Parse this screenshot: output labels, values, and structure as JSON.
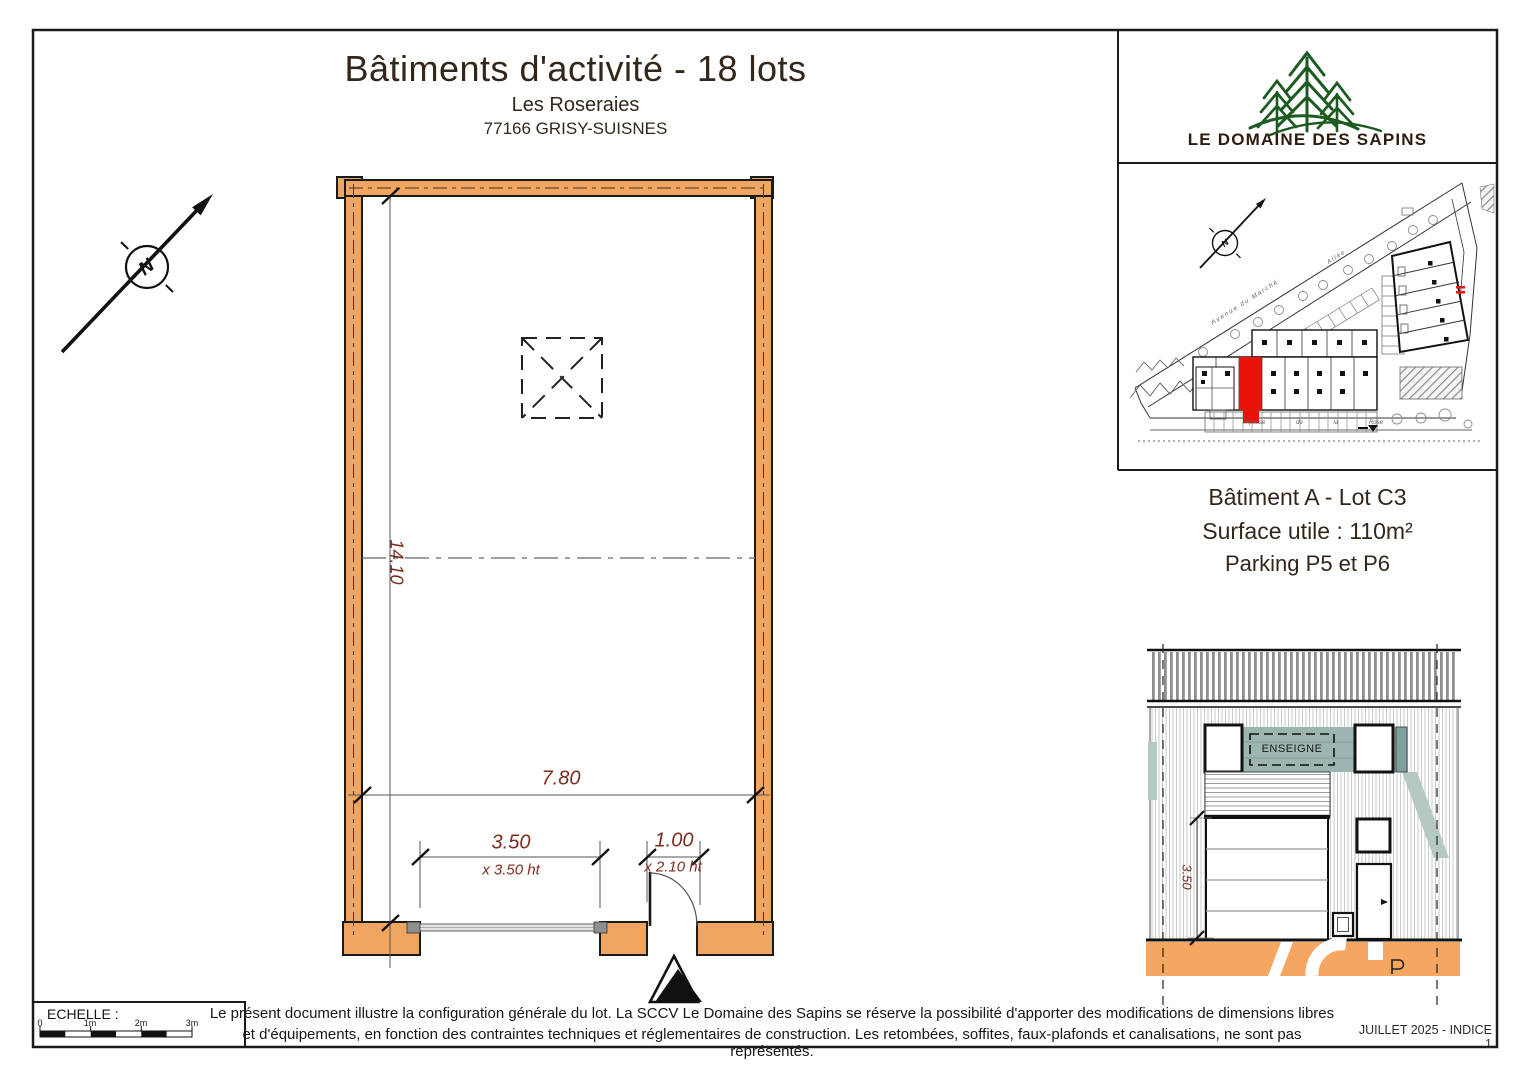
{
  "colors": {
    "wall": "#f0a660",
    "ground": "#f5a661",
    "dim": "#7a2e1f",
    "sign": "#9cb5b1",
    "shadow": "#b6c8c3",
    "green": "#1d5a20",
    "brown": "#33261b",
    "logobrown": "#2e1d0e",
    "red": "#e8140c"
  },
  "header": {
    "title": "Bâtiments d'activité - 18 lots",
    "subtitle": "Les Roseraies",
    "address": "77166 GRISY-SUISNES"
  },
  "logo": {
    "label": "LE DOMAINE DES SAPINS"
  },
  "site_inset": {
    "north": "N",
    "street_avenue": "Avenue du Marché",
    "street_allee": "Allée",
    "impasse": [
      "impasse",
      "de",
      "la",
      "Rose"
    ]
  },
  "lot": {
    "title": "Bâtiment A - Lot C3",
    "surface": "Surface utile : 110m²",
    "parking": "Parking P5 et P6"
  },
  "plan": {
    "north": "N",
    "dim_height": "14.10",
    "dim_width": "7.80",
    "garage_width": "3.50",
    "garage_height": "x 3.50 ht",
    "door_width": "1.00",
    "door_height": "x 2.10 ht"
  },
  "elevation": {
    "sign": "ENSEIGNE",
    "dim_height": "3.50"
  },
  "footer": {
    "scale_label": "ECHELLE :",
    "ticks": [
      "0",
      "1m",
      "2m",
      "3m"
    ],
    "disclaimer1": "Le présent document illustre la configuration générale du lot. La SCCV Le Domaine des Sapins se réserve la possibilité d'apporter des modifications de dimensions libres",
    "disclaimer2": "et d'équipements, en fonction des contraintes techniques et réglementaires de construction. Les retombées, soffites, faux-plafonds et canalisations, ne sont pas représentés.",
    "issue": "JUILLET 2025 - INDICE 1"
  }
}
